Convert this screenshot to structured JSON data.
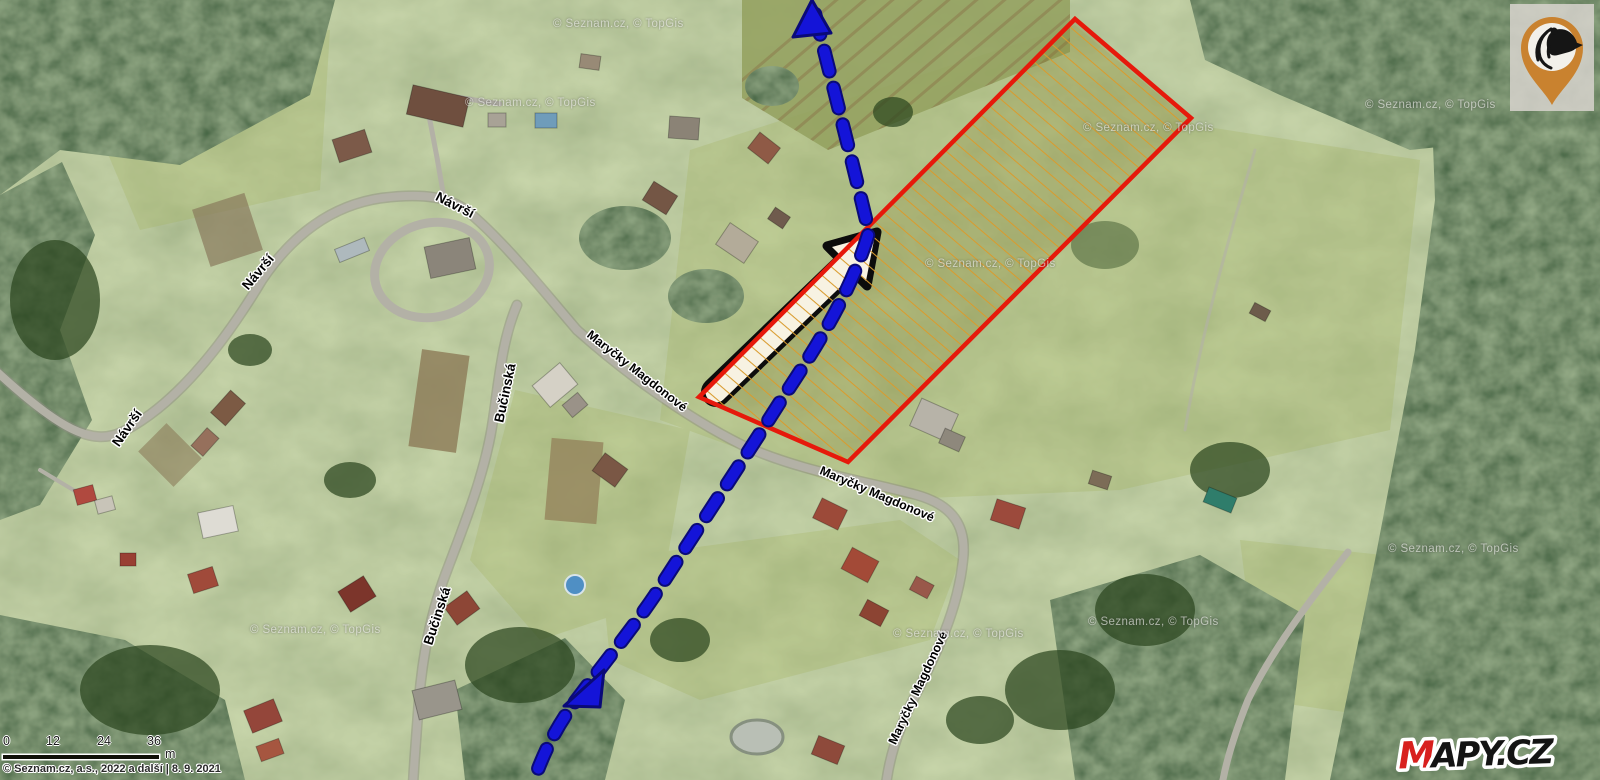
{
  "map": {
    "attribution": "© Seznam.cz, a.s., 2022 a další | 8. 9. 2021",
    "watermark_text": "© Seznam.cz, © TopGis",
    "street_labels": [
      {
        "text": "Návrší"
      },
      {
        "text": "Návrší"
      },
      {
        "text": "Návrší"
      },
      {
        "text": "Maryčky Magdonové"
      },
      {
        "text": "Maryčky Magdonové"
      },
      {
        "text": "Maryčky Magdonové"
      },
      {
        "text": "Bučinská"
      },
      {
        "text": "Bučinská"
      }
    ],
    "scale": {
      "ticks": [
        "0",
        "12",
        "24",
        "36"
      ],
      "unit": "m"
    },
    "logo": {
      "first_letter": "M",
      "rest": "APY.CZ"
    }
  },
  "overlay": {
    "parcel_outline_color": "#e6190b",
    "parcel_hatch_color": "#d99b2e",
    "route_color": "#1414d8",
    "route_border_color": "#0a0a78",
    "arrow_fill": "#f7f2e2",
    "arrow_outline": "#0c0c0c"
  }
}
